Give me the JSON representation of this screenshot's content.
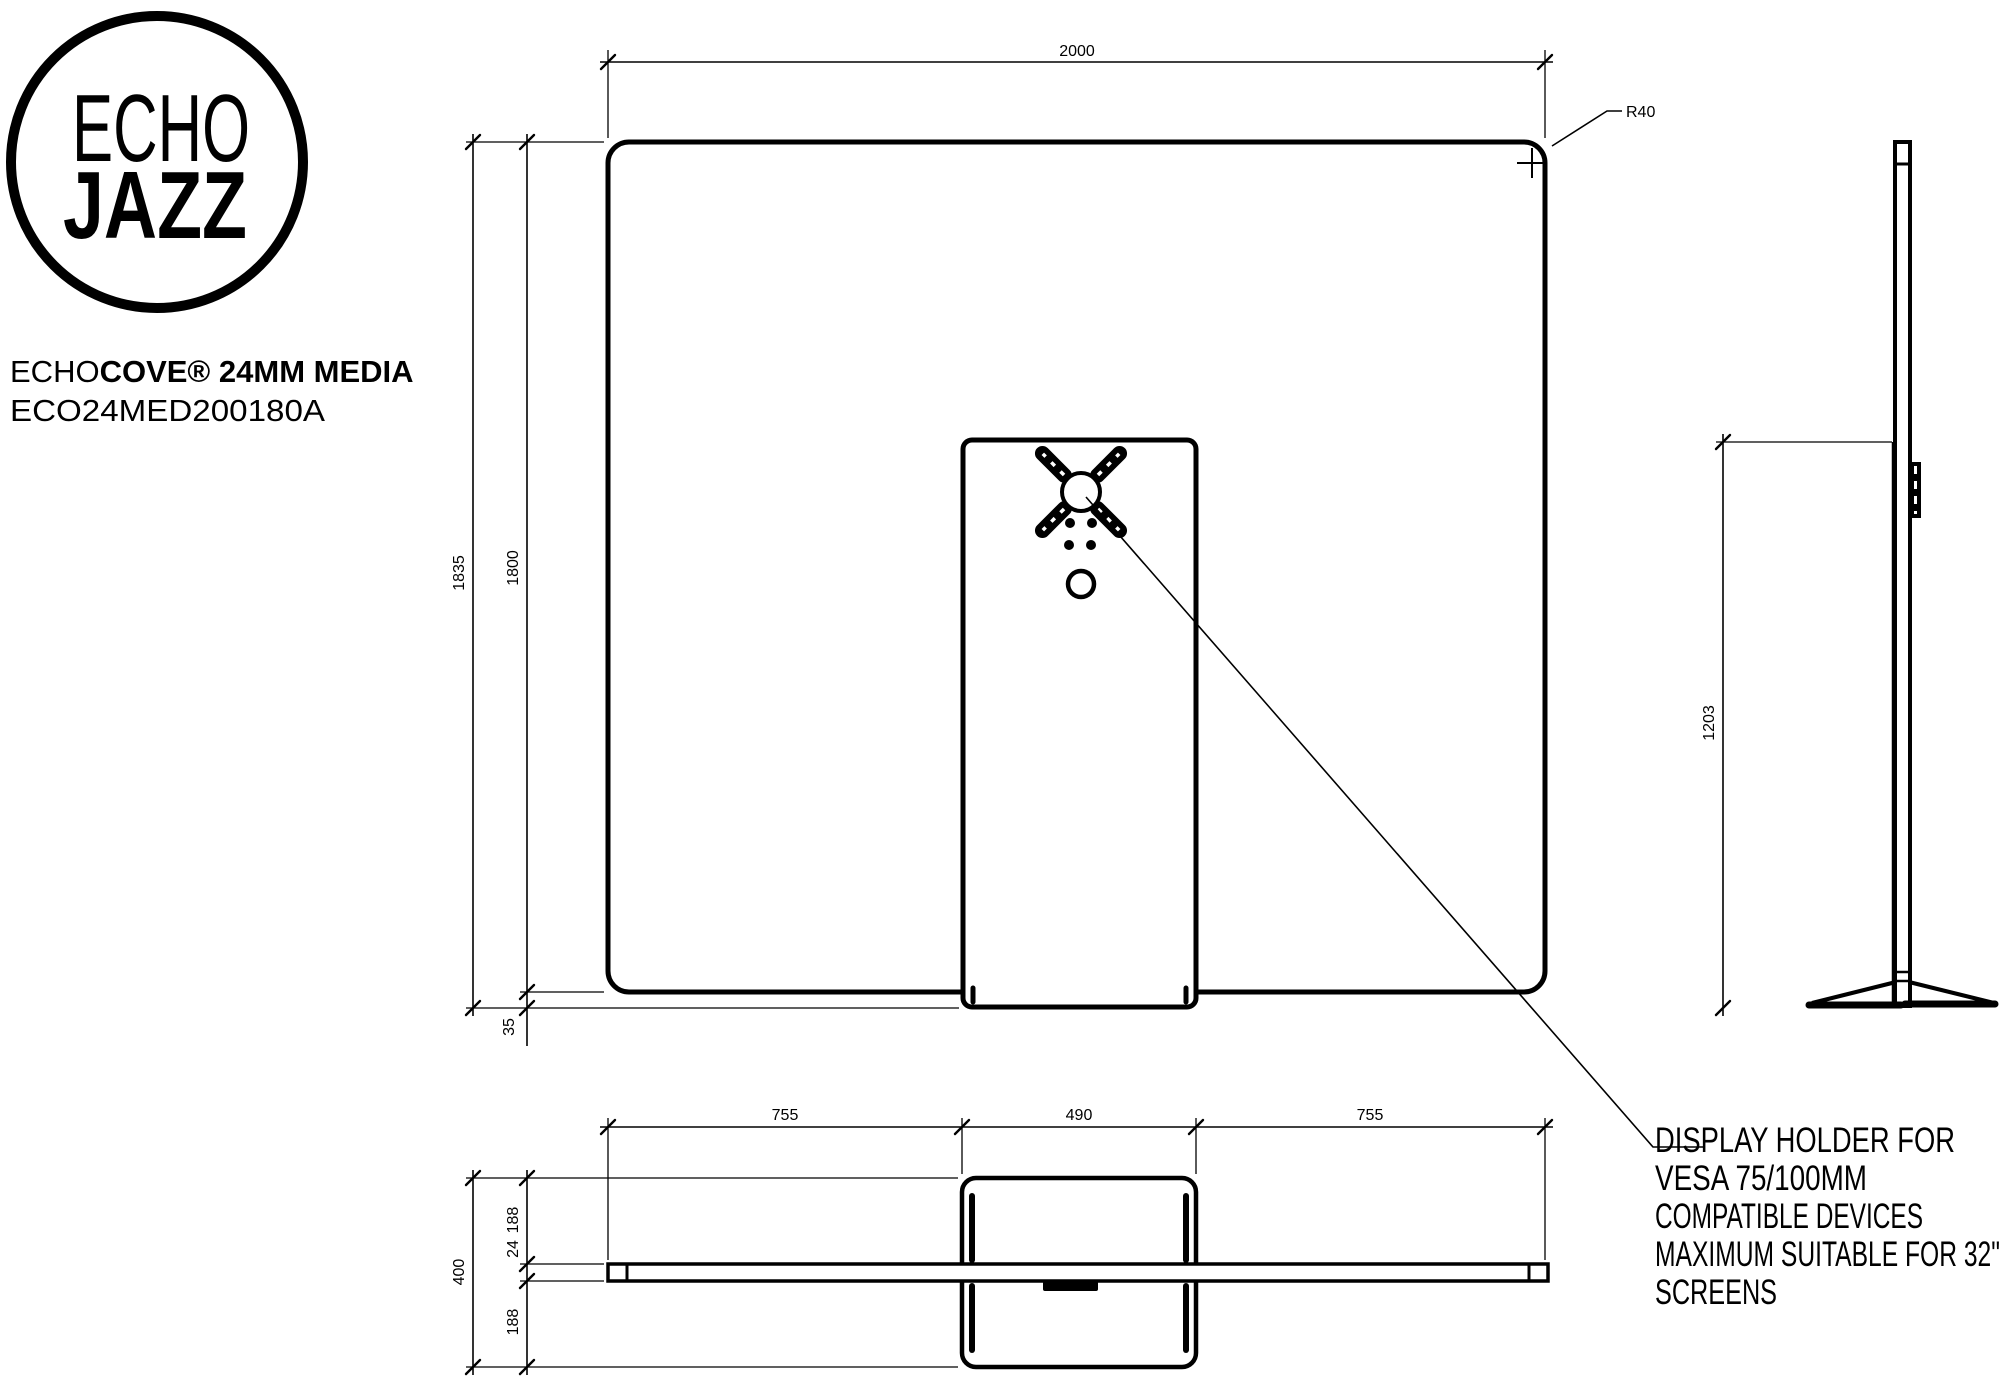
{
  "logo": {
    "word1": "ECHO",
    "word2": "JAZZ"
  },
  "title": {
    "brand_light": "ECHO",
    "brand_bold": "COVE® 24MM MEDIA",
    "code": "ECO24MED200180A"
  },
  "front_view": {
    "dim_width": "2000",
    "dim_corner_radius": "R40",
    "dim_total_height": "1835",
    "dim_panel_height": "1800",
    "dim_base_drop": "35"
  },
  "side_view": {
    "dim_holder_height": "1203"
  },
  "bottom_view": {
    "dim_seg_left": "755",
    "dim_seg_center": "490",
    "dim_seg_right": "755",
    "dim_depth_total": "400",
    "dim_depth_front": "188",
    "dim_panel_thickness": "24",
    "dim_depth_back": "188"
  },
  "note_lines": [
    "DISPLAY HOLDER FOR",
    "VESA 75/100MM",
    "COMPATIBLE DEVICES",
    "MAXIMUM SUITABLE FOR 32\"",
    "SCREENS"
  ],
  "colors": {
    "ink": "#000000",
    "background": "#ffffff"
  }
}
